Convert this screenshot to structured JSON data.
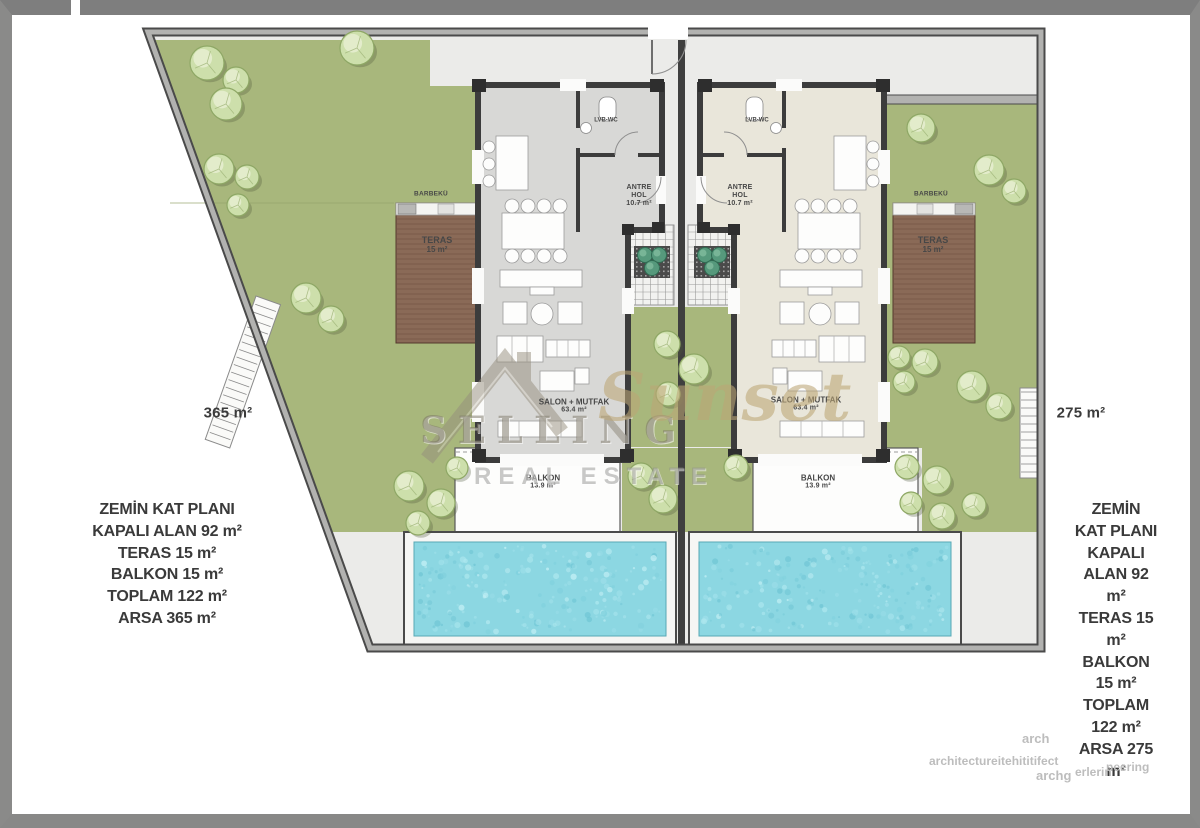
{
  "watermark": {
    "word_main": "SELLING",
    "word_script": "Sunset",
    "word_sub": "REAL ESTATE"
  },
  "lot_labels": {
    "left": "365 m²",
    "right": "275 m²"
  },
  "info_left": {
    "lines": [
      "ZEMİN KAT PLANI",
      "KAPALI ALAN 92 m²",
      "TERAS 15 m²",
      "BALKON 15 m²",
      "TOPLAM 122 m²",
      "ARSA 365 m²"
    ]
  },
  "info_right": {
    "lines": [
      "ZEMİN KAT PLANI",
      "KAPALI ALAN 92 m²",
      "TERAS 15 m²",
      "BALKON 15 m²",
      "TOPLAM 122 m²",
      "ARSA 275 m²"
    ]
  },
  "rooms": {
    "antre_line1": "ANTRE",
    "antre_line2": "HOL",
    "antre_area": "10.7 m²",
    "wc_label": "LVB-WC",
    "salon_name": "SALON + MUTFAK",
    "salon_area": "63.4 m²",
    "balkon_name": "BALKON",
    "balkon_area": "13.9 m²",
    "teras_name": "TERAS",
    "teras_area": "15 m²",
    "barbeku_label": "BARBEKÜ"
  },
  "colors": {
    "pool_water": "#8cd7e2",
    "grass": "#a8b77c",
    "terrace_wood": "#8a6a57",
    "wall_grey": "#b2b2b0",
    "floor_left_villa": "#d8d8d6",
    "floor_right_villa": "#e9e6da"
  },
  "footer_fragments": {
    "f1": "arch",
    "f2": "architectureitehititifect",
    "f3": "archg",
    "f4": "erlerin",
    "f5": "neering"
  }
}
